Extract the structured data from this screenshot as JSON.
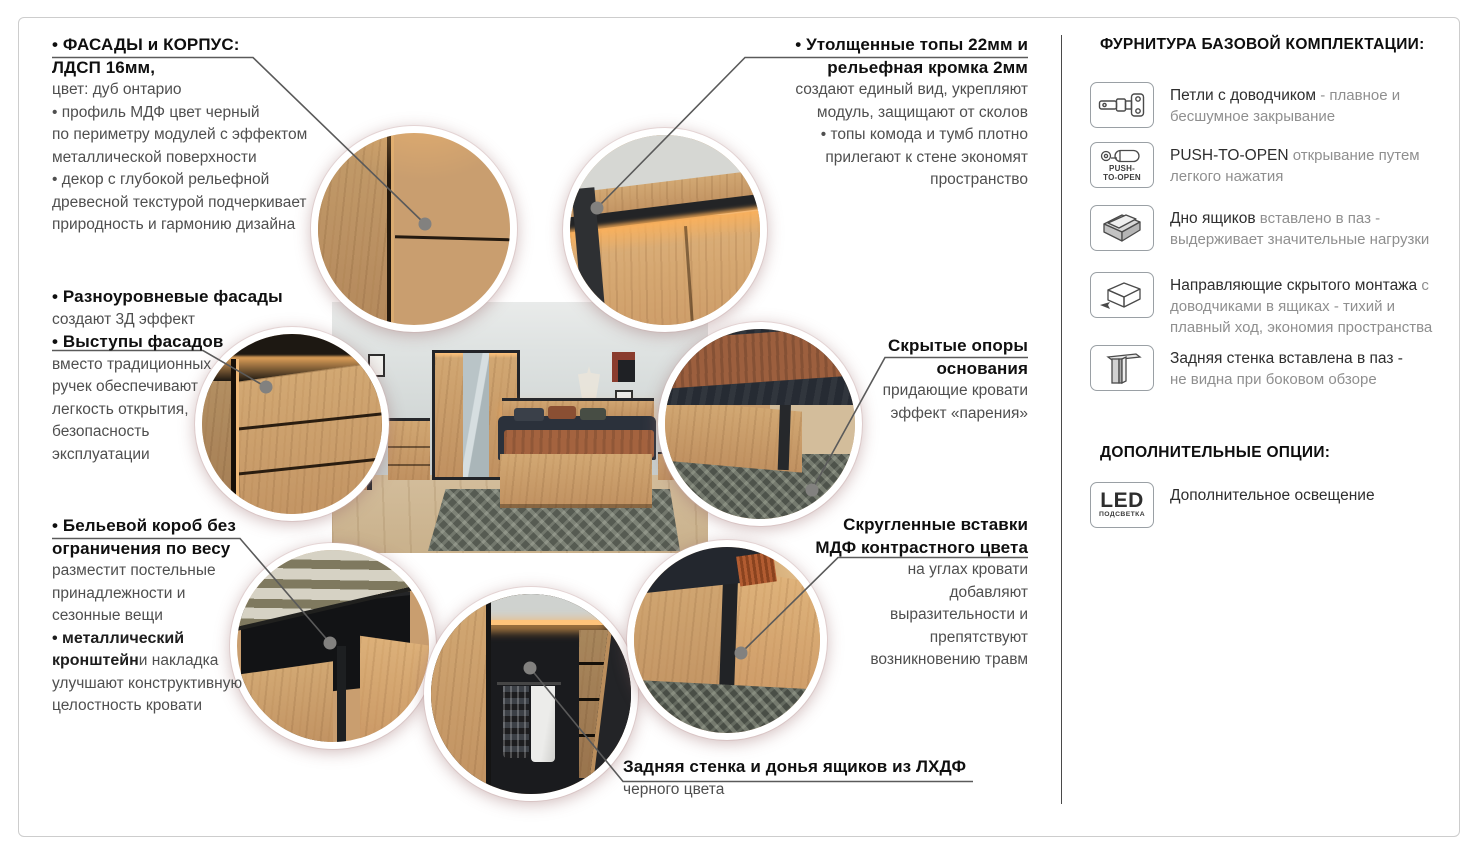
{
  "colors": {
    "wood": "#c89a6a",
    "trim_black": "#26282b",
    "led_glow": "#ffb765",
    "connector_gray": "#5a5a5a",
    "heading_text": "#0f0f0f",
    "body_text": "#4f4f4f",
    "muted_text": "#8f8f8f"
  },
  "callouts": {
    "facades": {
      "lines": [
        [
          [
            "h",
            "• ФАСАДЫ и КОРПУС:"
          ]
        ],
        [
          [
            "h",
            "ЛДСП 16мм,"
          ]
        ],
        [
          [
            "b",
            "цвет: дуб онтарио"
          ]
        ],
        [
          [
            "b",
            "• профиль МДФ цвет черный"
          ]
        ],
        [
          [
            "b",
            "по периметру модулей с эффектом"
          ]
        ],
        [
          [
            "b",
            "металлической поверхности"
          ]
        ],
        [
          [
            "b",
            "• декор с глубокой рельефной"
          ]
        ],
        [
          [
            "b",
            "древесной текстурой подчеркивает"
          ]
        ],
        [
          [
            "b",
            "природность и гармонию дизайна"
          ]
        ]
      ]
    },
    "multilevel": {
      "lines": [
        [
          [
            "h",
            "• Разноуровневые фасады"
          ]
        ],
        [
          [
            "b",
            "создают 3Д эффект"
          ]
        ],
        [
          [
            "h",
            "• Выступы фасадов"
          ]
        ],
        [
          [
            "b",
            "вместо традиционных"
          ]
        ],
        [
          [
            "b",
            "ручек обеспечивают"
          ]
        ],
        [
          [
            "b",
            "легкость открытия,"
          ]
        ],
        [
          [
            "b",
            "безопасность"
          ]
        ],
        [
          [
            "b",
            "эксплуатации"
          ]
        ]
      ]
    },
    "linen_box": {
      "lines": [
        [
          [
            "h",
            "• Бельевой короб без"
          ]
        ],
        [
          [
            "h",
            "ограничения по весу"
          ]
        ],
        [
          [
            "b",
            "разместит постельные"
          ]
        ],
        [
          [
            "b",
            "принадлежности и"
          ]
        ],
        [
          [
            "b",
            "сезонные вещи"
          ]
        ],
        [
          [
            "d",
            "• металлический"
          ]
        ],
        [
          [
            "d",
            "кронштейн"
          ],
          [
            "b",
            " и накладка"
          ]
        ],
        [
          [
            "b",
            "улучшают конструктивную"
          ]
        ],
        [
          [
            "b",
            "целостность кровати"
          ]
        ]
      ]
    },
    "tops": {
      "lines": [
        [
          [
            "h",
            "• Утолщенные топы 22мм и"
          ]
        ],
        [
          [
            "h",
            "рельефная кромка 2мм"
          ]
        ],
        [
          [
            "b",
            "создают единый вид, укрепляют"
          ]
        ],
        [
          [
            "b",
            "модуль, защищают от сколов"
          ]
        ],
        [
          [
            "b",
            "• топы комода и тумб плотно"
          ]
        ],
        [
          [
            "b",
            "прилегают к стене экономят"
          ]
        ],
        [
          [
            "b",
            "пространство"
          ]
        ]
      ]
    },
    "hidden_supports": {
      "lines": [
        [
          [
            "h",
            "Скрытые опоры"
          ]
        ],
        [
          [
            "h",
            "основания"
          ]
        ],
        [
          [
            "b",
            "придающие кровати"
          ]
        ],
        [
          [
            "b",
            "эффект «парения»"
          ]
        ]
      ]
    },
    "rounded_inserts": {
      "lines": [
        [
          [
            "h",
            "Скругленные вставки"
          ]
        ],
        [
          [
            "h",
            "МДФ контрастного цвета"
          ]
        ],
        [
          [
            "b",
            "на углах кровати"
          ]
        ],
        [
          [
            "b",
            "добавляют"
          ]
        ],
        [
          [
            "b",
            "выразительности и"
          ]
        ],
        [
          [
            "b",
            "препятствуют"
          ]
        ],
        [
          [
            "b",
            "возникновению травм"
          ]
        ]
      ]
    },
    "back_panel": {
      "lines": [
        [
          [
            "h",
            "Задняя стенка и донья ящиков из ЛХДФ"
          ]
        ],
        [
          [
            "b",
            "черного цвета"
          ]
        ]
      ]
    }
  },
  "sidebar": {
    "hardware_title": "ФУРНИТУРА БАЗОВОЙ КОМПЛЕКТАЦИИ:",
    "items": [
      {
        "icon": "hinge-icon",
        "segments": [
          [
            "d",
            "Петли с доводчиком"
          ],
          [
            "r",
            " - плавное и бесшумное закрывание"
          ]
        ]
      },
      {
        "icon": "push-to-open-icon",
        "caption": [
          "PUSH-",
          "TO-OPEN"
        ],
        "segments": [
          [
            "d",
            "PUSH-TO-OPEN"
          ],
          [
            "r",
            " открывание путем легкого нажатия"
          ]
        ]
      },
      {
        "icon": "drawer-bottom-icon",
        "segments": [
          [
            "d",
            "Дно ящиков"
          ],
          [
            "r",
            " вставлено в паз - выдерживает значительные нагрузки"
          ]
        ]
      },
      {
        "icon": "drawer-slides-icon",
        "segments": [
          [
            "d",
            "Направляющие скрытого монтажа"
          ],
          [
            "r",
            " с доводчиками в ящиках - тихий и плавный ход, экономия пространства"
          ]
        ]
      },
      {
        "icon": "back-panel-icon",
        "segments": [
          [
            "d",
            "Задняя стенка вставлена в паз -"
          ],
          [
            "br",
            ""
          ],
          [
            "r",
            "не видна при боковом обзоре"
          ]
        ]
      }
    ],
    "options_title": "ДОПОЛНИТЕЛЬНЫЕ ОПЦИИ:",
    "options": [
      {
        "icon": "led-icon",
        "caption": [
          "LED",
          "ПОДСВЕТКА"
        ],
        "segments": [
          [
            "d",
            "Дополнительное освещение"
          ]
        ]
      }
    ]
  }
}
